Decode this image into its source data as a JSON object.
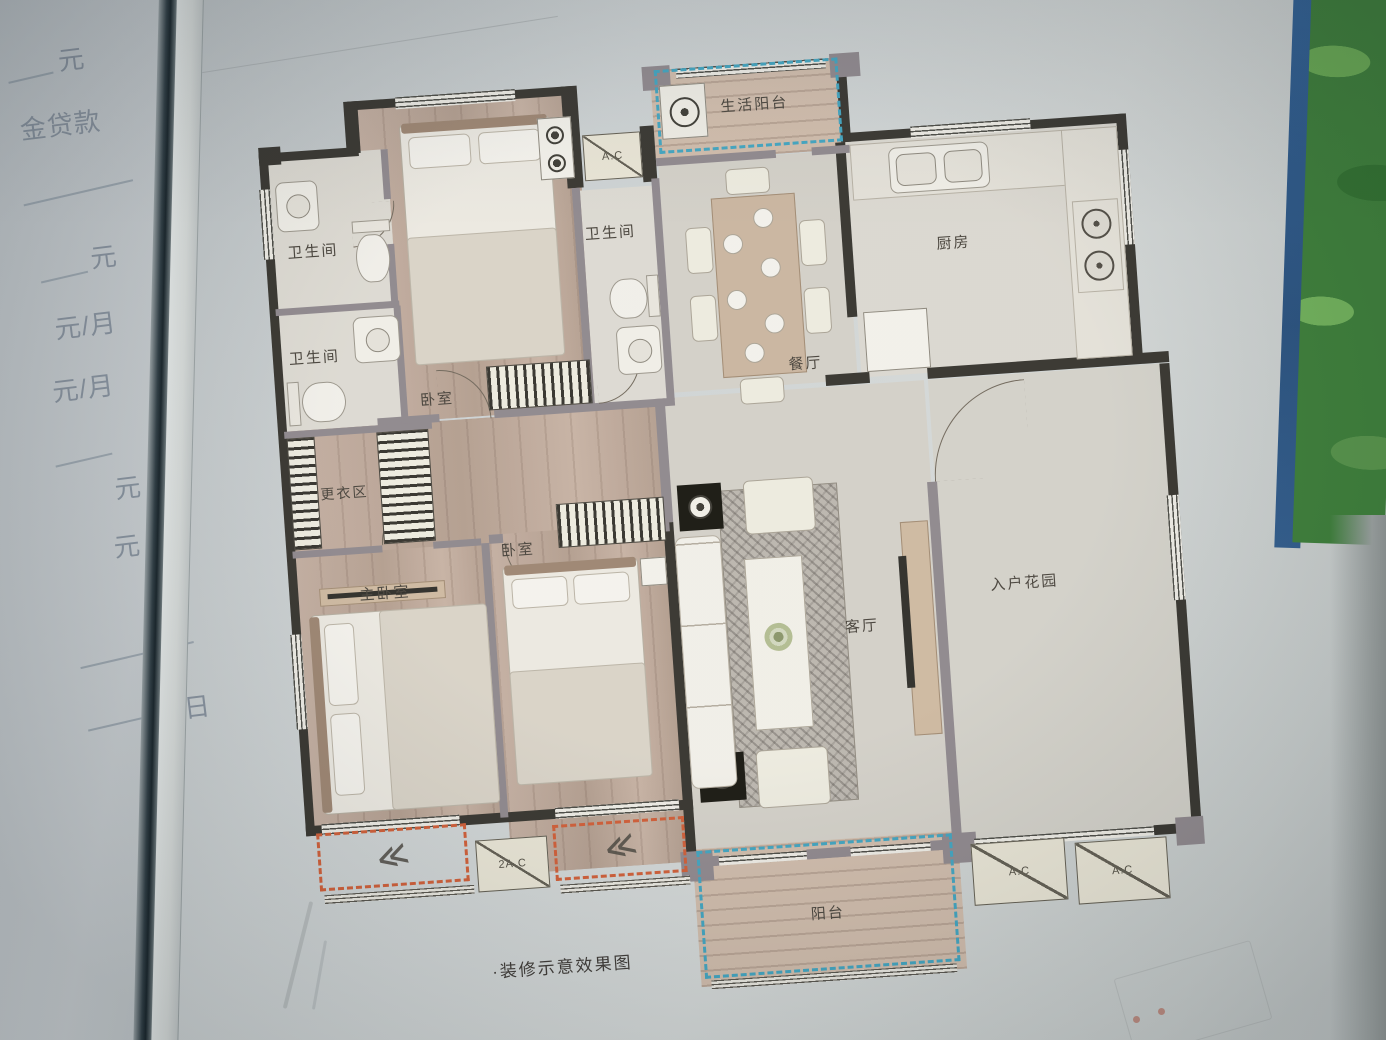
{
  "left_page": {
    "items": [
      "元",
      "金贷款",
      "元",
      "元/月",
      "元/月",
      "元",
      "元",
      "日"
    ]
  },
  "plan": {
    "rooms": {
      "service_balcony": "生活阳台",
      "bathroom_1": "卫生间",
      "bathroom_2": "卫生间",
      "bathroom_3": "卫生间",
      "kitchen": "厨房",
      "dining": "餐厅",
      "bedroom_top": "卧室",
      "dressing": "更衣区",
      "master_bedroom": "主卧室",
      "bedroom_mid": "卧室",
      "living": "客厅",
      "entry_garden": "入户花园",
      "balcony": "阳台"
    },
    "ac": {
      "top": "A.C",
      "double": "2A.C",
      "right_1": "A.C",
      "right_2": "A.C"
    },
    "caption": "·装修示意效果图",
    "icons": {
      "louver": "≪"
    },
    "colors": {
      "dash_blue": "#3fa3bf",
      "dash_orange": "#cf5c35",
      "wall_dark": "#35332d",
      "wall_gray": "#8e878c",
      "wood": "#b9a496",
      "leaf_green": "#3a7d36",
      "cover_blue": "#2e5f95"
    }
  }
}
